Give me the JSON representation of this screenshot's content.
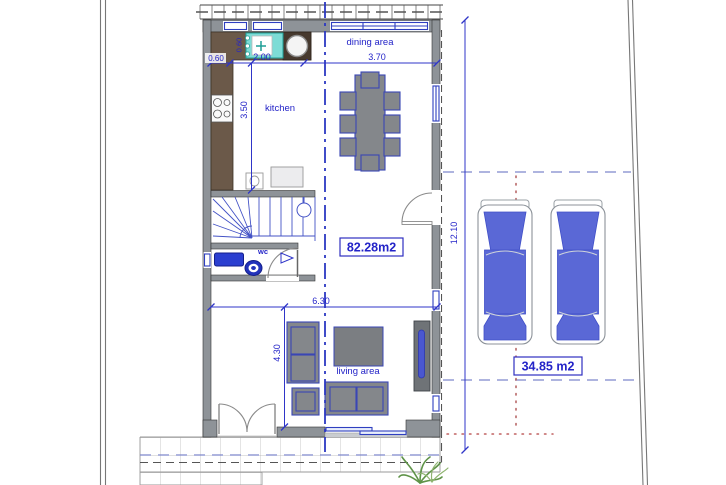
{
  "plan": {
    "rooms": {
      "dining": "dining area",
      "kitchen": "kitchen",
      "wc": "wc",
      "living": "living area"
    },
    "area_labels": {
      "floor": "82.28m2",
      "parking": "34.85 m2"
    },
    "dims": {
      "counter_width": "0.60",
      "counter_depth": "0.60",
      "kitchen_width": "2.00",
      "dining_width": "3.70",
      "kitchen_depth": "3.50",
      "living_width": "6.30",
      "living_depth": "4.30",
      "plot_depth": "12.10"
    },
    "colors": {
      "annotation_blue": "#2f35c8",
      "wall_gray": "#8e9398",
      "counter_brown": "#6b5949",
      "sink_teal": "#7ddcd6",
      "fixture_blue": "#2b3fd0",
      "car_blue": "#5a68d6",
      "guide_dash_blue": "#7e88cc",
      "guide_dot_red": "#b25b5b",
      "plant_green": "#5f9348"
    }
  }
}
